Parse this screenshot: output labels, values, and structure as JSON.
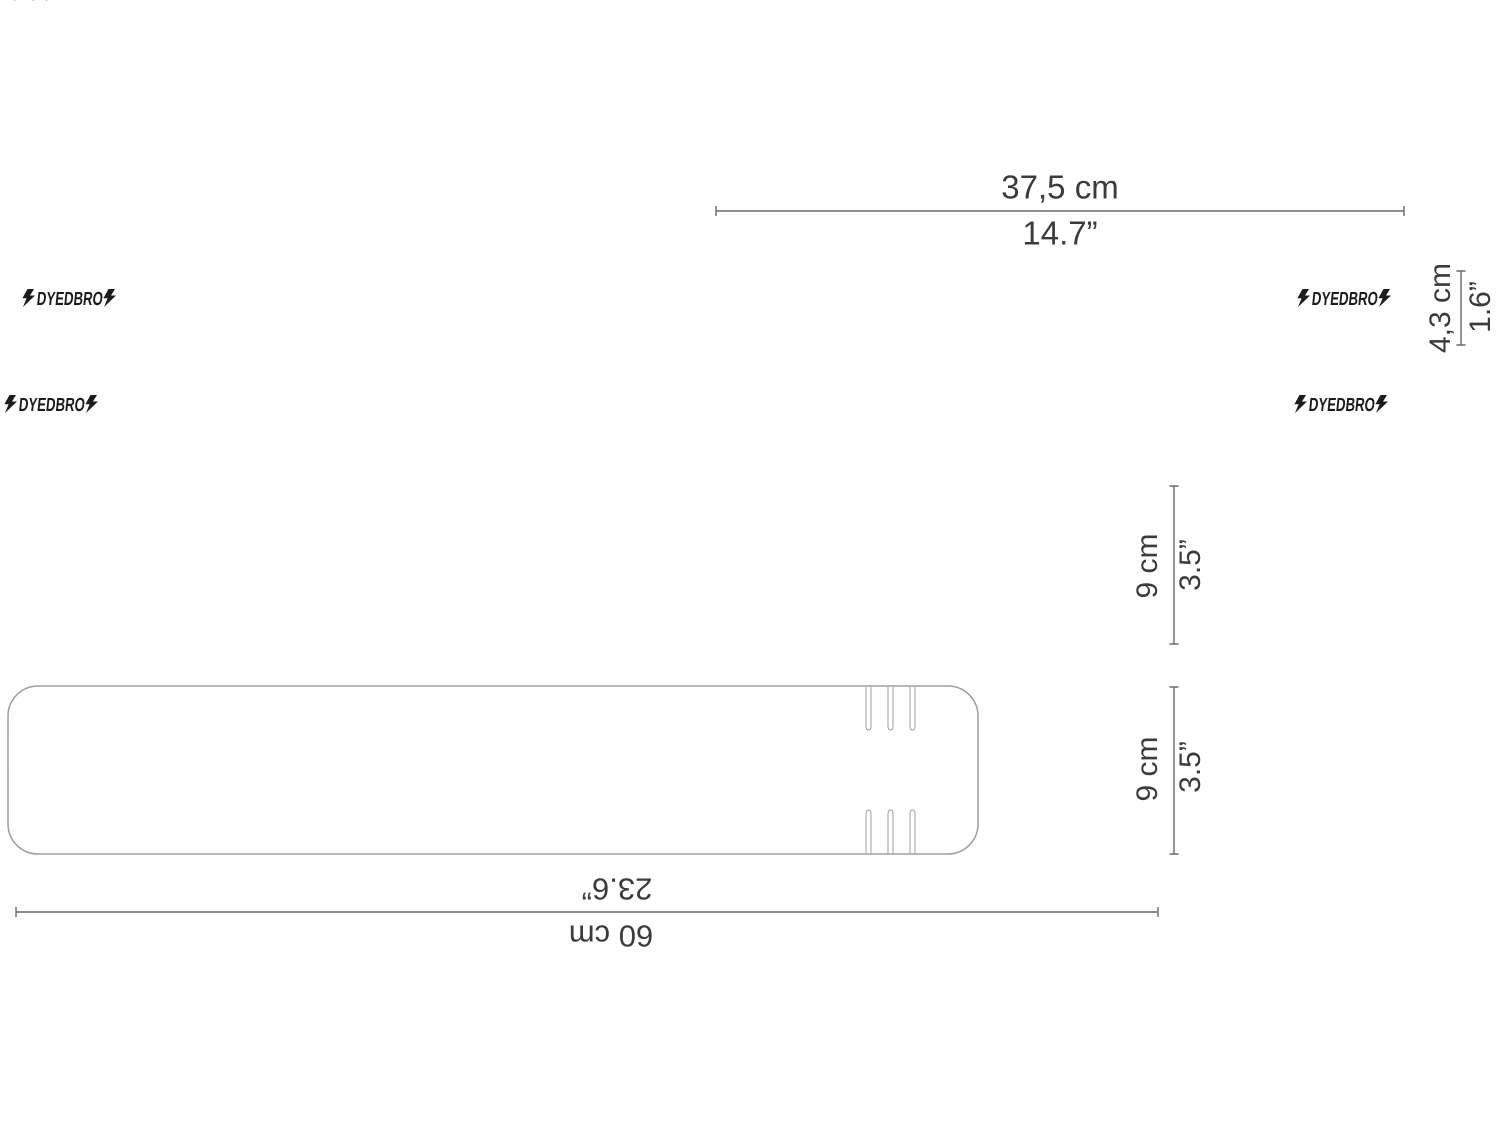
{
  "product": {
    "brand": "DYEDBRO",
    "url": "DYEDBRO.COM"
  },
  "icons": {
    "lightning_bolt": "zigzag-bolt-shape"
  },
  "colors": {
    "teal": "#1a8c80",
    "grey": "#d9d8d5",
    "cream": "#ecdab0",
    "ink": "#1c1c1a",
    "label": "#3b3b3a",
    "line": "#6a6a6a",
    "outline": "#a3a3a1"
  },
  "dimensions": {
    "top_width": {
      "cm": "37,5 cm",
      "inches": "14.7”"
    },
    "strip_height": {
      "cm": "4,3 cm",
      "inches": "1.6”"
    },
    "frame_piece_height": {
      "cm": "9 cm",
      "inches": "3.5”"
    },
    "bottom_piece_height": {
      "cm": "9 cm",
      "inches": "3.5”"
    },
    "bottom_length": {
      "cm": "60 cm",
      "inches": "23.6”"
    }
  }
}
